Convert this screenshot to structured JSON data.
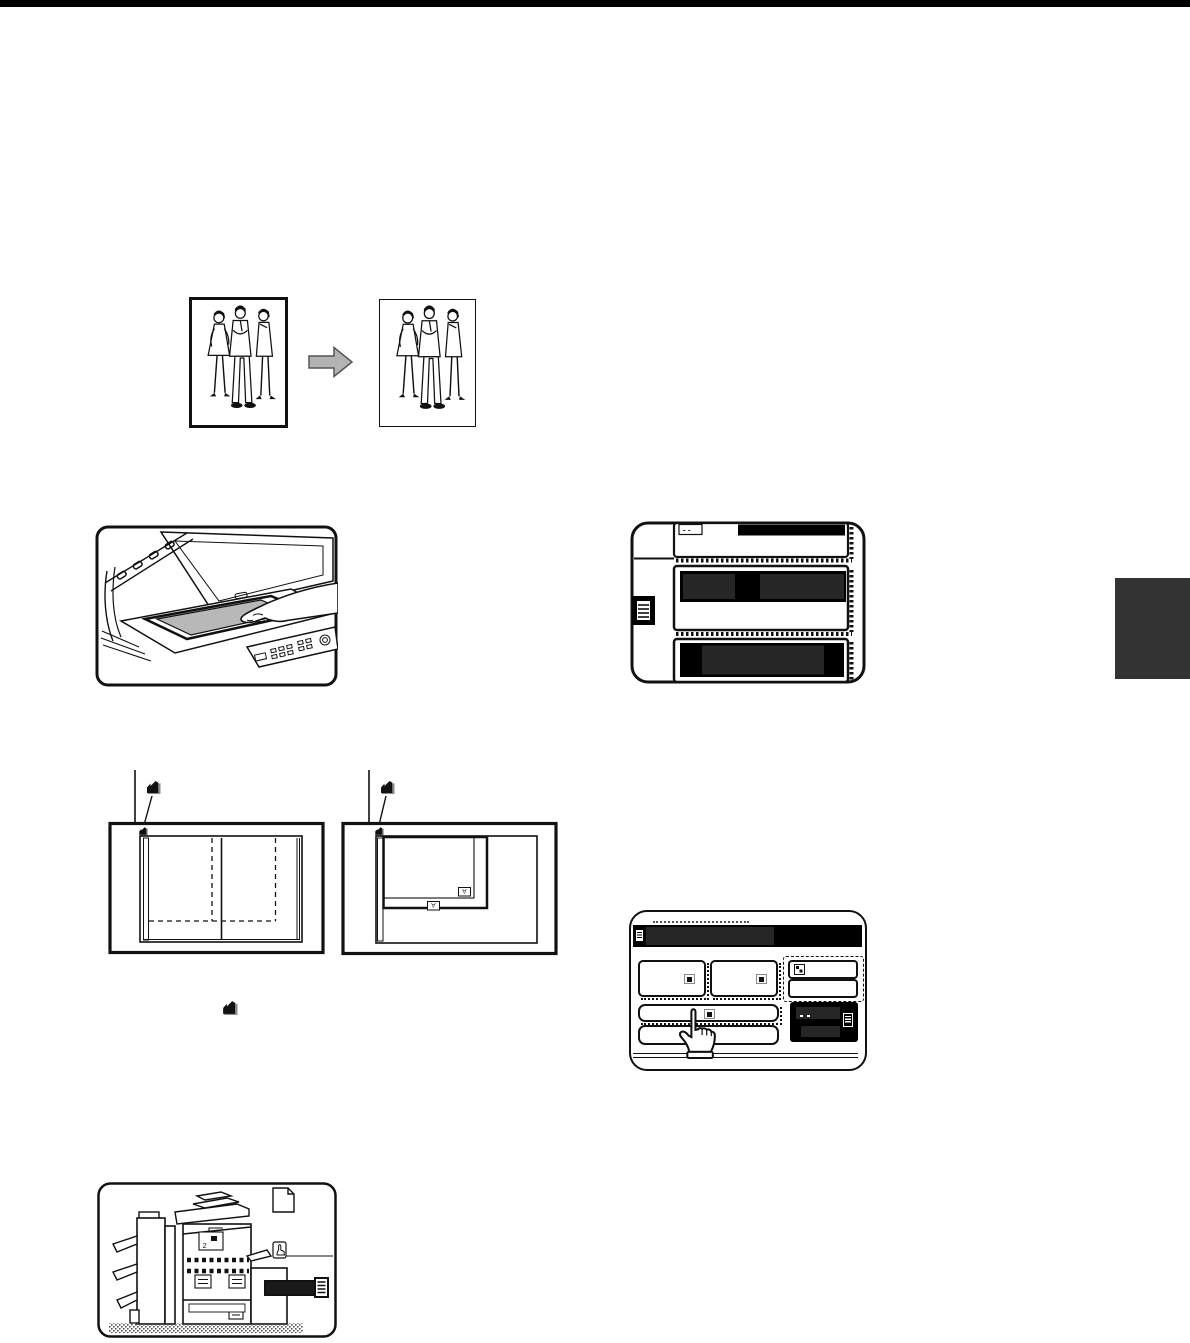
{
  "page": {
    "background": "#ffffff",
    "top_bar_color": "#000000",
    "chapter_tab_color": "#333333"
  },
  "figures": {
    "original_to_copy": {
      "arrow_color": "#b3b3b3"
    },
    "platen": {
      "document_color": "#b8b8b8"
    },
    "paper_trays": {
      "tray_label_marks": "- -",
      "display_color": "#000000",
      "display_inner_color": "#262626"
    },
    "size_diagram": {
      "size_label_inner": "A",
      "size_label_outer": "A"
    },
    "touch_screen": {
      "redaction_color": "#262626"
    },
    "machine": {
      "panel_label": "2",
      "label_bar_color": "#1a1a1a"
    }
  },
  "icons": {
    "index-mark-icon": "black corner index mark ◤",
    "pointing-hand-icon": "white glove pointing cursor",
    "hand-in-box-icon": "small pointing hand in rounded box",
    "page-icon": "dog-eared page outline",
    "document-icon": "small white page glyph",
    "booklet-icon": "box with horizontal stripes",
    "key-icon": "small square key face",
    "handle-icon": "striped tray handle",
    "arrow-right-icon": "gray block arrow"
  }
}
